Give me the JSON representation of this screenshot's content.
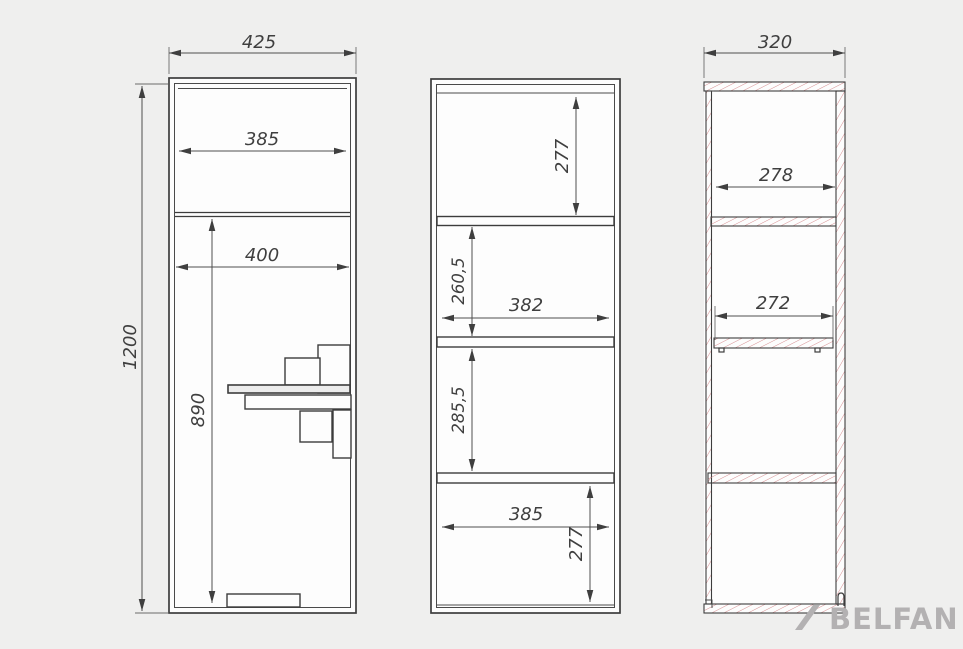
{
  "views": {
    "front": {
      "dims": {
        "overall_width": "425",
        "overall_height": "1200",
        "top_inner_width": "385",
        "inner_width": "400",
        "lower_height": "890"
      }
    },
    "section": {
      "dims": {
        "top_compartment": "277",
        "second_compartment": "260,5",
        "inner_width": "382",
        "third_compartment": "285,5",
        "bottom_inner_width": "385",
        "bottom_compartment": "277"
      }
    },
    "side": {
      "dims": {
        "overall_depth": "320",
        "top_inner_depth": "278",
        "shelf_depth": "272"
      }
    },
    "logo": {
      "text": "BELFAN"
    }
  },
  "icons": {
    "logo_slash": "diagonal-slash"
  },
  "colors": {
    "background": "#efefee",
    "paper": "#fdfdfd",
    "line": "#3d3d3d",
    "hatch": "#d68f91",
    "logo": "#b3b1b2"
  }
}
